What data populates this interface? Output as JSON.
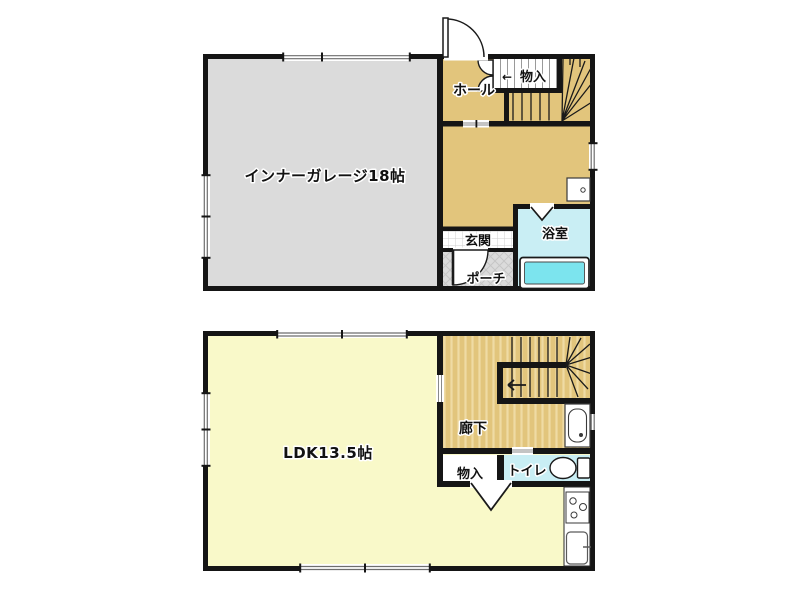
{
  "floor1": {
    "garage": "インナーガレージ18帖",
    "hall": "ホール",
    "storage_arrow": "←",
    "storage": "物入",
    "entrance": "玄関",
    "porch": "ポーチ",
    "bathroom": "浴室"
  },
  "floor2": {
    "ldk": "LDK13.5帖",
    "corridor": "廊下",
    "storage": "物入",
    "toilet": "トイレ"
  },
  "colors": {
    "wall": "#151515",
    "garage_fill": "#dbdbdb",
    "wood_fill": "#e2c57c",
    "wood_stripe": "#efdba4",
    "ldk_fill": "#f9f9c9",
    "wet_room_fill": "#c9eef4",
    "bathtub_fill": "#7ce4ee",
    "porch_fill": "#dbdbdb",
    "tile_line": "#cfcfcf"
  }
}
